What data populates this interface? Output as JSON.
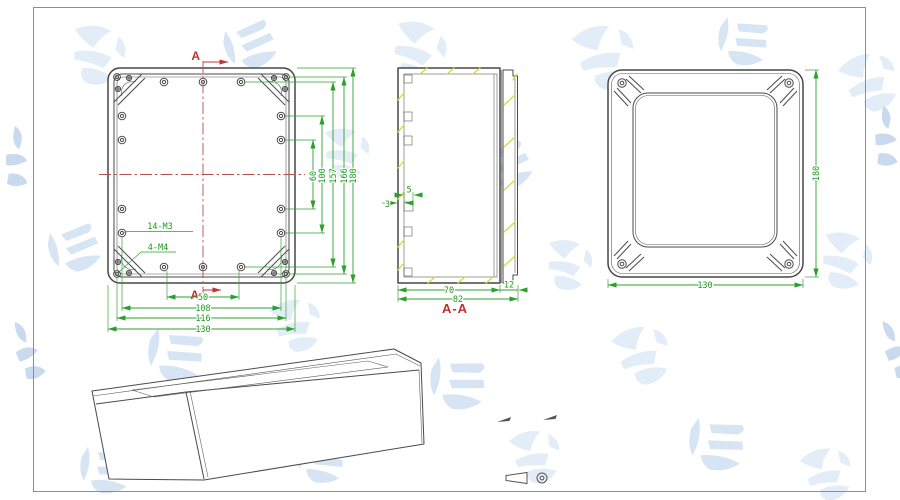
{
  "drawing": {
    "front_view": {
      "section_marker": "A",
      "label_small_holes": "14-M3",
      "label_corner_holes": "4-M4",
      "dims_vertical": [
        "60",
        "100",
        "157",
        "166",
        "180"
      ],
      "dims_horizontal": [
        "50",
        "108",
        "116",
        "130"
      ]
    },
    "section_view": {
      "label": "A-A",
      "dim_boss_width": "5",
      "dim_wall_thickness": "3",
      "dim_inner_depth": "70",
      "dim_total_depth": "82",
      "dim_lid_depth": "12"
    },
    "back_view": {
      "dim_height": "180",
      "dim_width": "130"
    },
    "colors": {
      "outline": "#4a4a4a",
      "dimension": "#2ca02c",
      "centerline": "#b4504c",
      "section_label": "#c2302c",
      "hatch": "#d8d83c",
      "watermark": "#dce8f6",
      "background": "#ffffff",
      "frame": "#8f8f8f"
    }
  }
}
